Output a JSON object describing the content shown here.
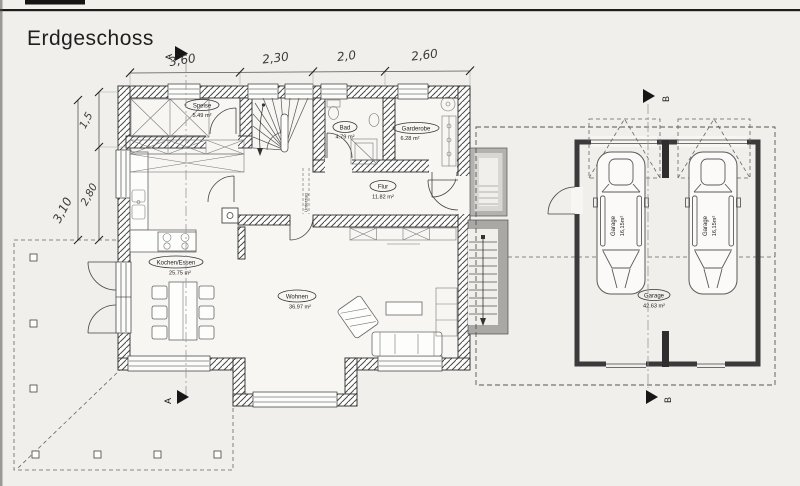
{
  "title": "Erdgeschoss",
  "rooms": {
    "speise": {
      "name": "Speise",
      "area": "5.49 m²"
    },
    "bad": {
      "name": "Bad",
      "area": "4.79 m²"
    },
    "garderobe": {
      "name": "Garderobe",
      "area": "6.28 m²"
    },
    "flur": {
      "name": "Flur",
      "area": "11.82 m²"
    },
    "kochen": {
      "name": "Kochen/Essen",
      "area": "25.75 m²"
    },
    "wohnen": {
      "name": "Wohnen",
      "area": "36.97 m²"
    },
    "garage_left": {
      "name": "Garage",
      "area": "16,15m²"
    },
    "garage_right": {
      "name": "Garage",
      "area": "16,15m²"
    },
    "garage_total": {
      "name": "Garage",
      "area": "42.63 m²"
    }
  },
  "dimensions": {
    "top": {
      "d1": "3,60",
      "d2": "2,30",
      "d3": "2,0",
      "d4": "2,60"
    },
    "left": {
      "d1": "1,5",
      "d2": "2,80",
      "d3": "3,10"
    }
  },
  "sections": {
    "a": "A",
    "b": "B"
  },
  "annotations": {
    "beam": "Unterzug"
  },
  "colors": {
    "paper": "#f0efeb",
    "ink": "#2b2b2b",
    "wall_line": "#333333",
    "concrete": "#a9a8a5"
  }
}
